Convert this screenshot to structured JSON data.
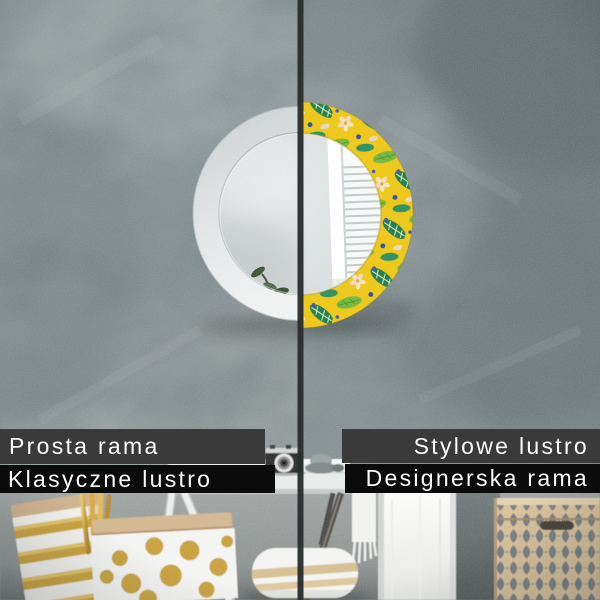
{
  "overlay_labels": {
    "left_top": "Prosta rama",
    "left_bottom": "Klasyczne lustro",
    "right_top": "Stylowe lustro",
    "right_bottom": "Designerska rama"
  },
  "colors": {
    "label_bar_dark_gray": "#3a3a3a",
    "label_bar_black": "#0b0b0b",
    "label_text": "#fcfcfc",
    "divider_line": "#2b2e2f",
    "plain_frame_white": "#e9ebeb",
    "pattern_yellow": "#edc715",
    "pattern_green_light": "#74b83e",
    "pattern_green_dark": "#1f7a4f",
    "pattern_cream": "#f3e3c6",
    "pattern_blue": "#3b55b8",
    "gold_accent": "#c9a23b",
    "box_beige": "#d9c19b",
    "box_diamond_gray": "#777f82"
  },
  "scene_objects": [
    "gray concrete wall",
    "round wall mirror split in half",
    "plain white frame left half",
    "tropical patterned frame right half",
    "window shutters reflection",
    "plant reflection",
    "white console shelf",
    "vintage camera",
    "gray knit hat on shelf",
    "gift bag with gold stripes",
    "gift bag with gold dots",
    "gold reed sticks",
    "white trestle table legs",
    "dark metal chair leg",
    "white hanging towel",
    "fringed throw",
    "pillow with gold stripes",
    "beige storage box with diamond pattern",
    "vertical comparison divider"
  ]
}
